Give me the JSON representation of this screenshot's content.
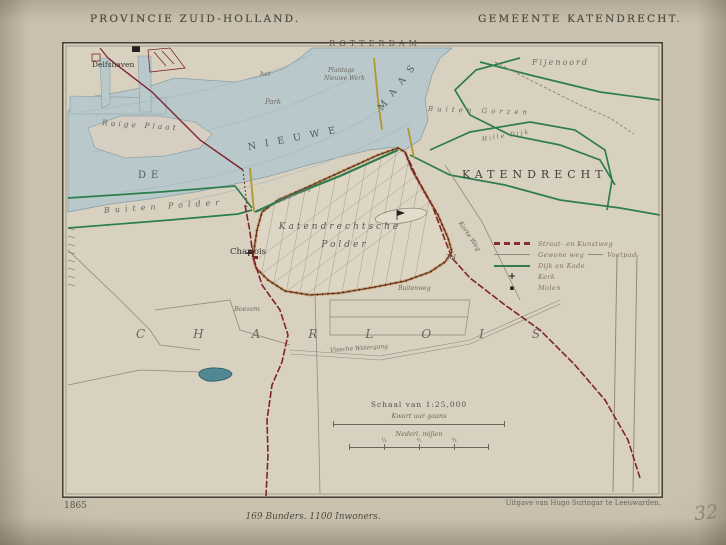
{
  "header": {
    "province": "PROVINCIE ZUID-HOLLAND.",
    "municipality": "GEMEENTE KATENDRECHT."
  },
  "map": {
    "labels": {
      "rotterdam": "ROTTERDAM",
      "delfshaven": "Delfshaven",
      "fijenoord": "Fijenoord",
      "het": "het",
      "park": "Park",
      "plantage": "Plantage",
      "nieuwe_werk": "Nieuwe Werk",
      "ruige_plaat": "Ruige Plaat",
      "de": "DE",
      "nieuwe": "NIEUWE",
      "maas": "MAAS",
      "katendrecht": "KATENDRECHT",
      "buiten_gorzen": "Buiten Gorzen",
      "hille_dijk": "Hille Dijk",
      "buiten_polder": "Buiten Polder",
      "buiten_weg": "Buiten Weg",
      "katendrechtsche": "Katendrechtsche",
      "polder": "Polder",
      "charlois_village": "Charlois",
      "boezem": "Boezem",
      "charlois": "CHARLOIS",
      "watergang": "Vissche Watergang",
      "buitenweg": "Buitenweg",
      "korte_weg": "Korte Weg",
      "tol": "Tol"
    },
    "symbols": {
      "church_cross": "+"
    }
  },
  "legend": {
    "items": [
      {
        "label": "Straat- en Kunstweg"
      },
      {
        "label": "Gewone weg",
        "label2": "Voetpad"
      },
      {
        "label": "Dijk en Kade"
      },
      {
        "symbol": "+",
        "label": "Kerk"
      },
      {
        "symbol": "▪",
        "label": "Molen"
      }
    ]
  },
  "scale": {
    "title": "Schaal van 1:25,000",
    "bar1_label": "Kwart uur gaans",
    "bar2_label": "Nederl. mijlen",
    "bar2_ticks": [
      "¼",
      "½",
      "¾"
    ]
  },
  "footer": {
    "year": "1865",
    "publisher": "Uitgave van Hugo Suringar te Leeuwarden.",
    "statistics": "169 Bunders. 1100 Inwoners.",
    "handwritten_number": "32"
  },
  "colors": {
    "paper": "#d9d1c0",
    "water": "#b9c8cb",
    "dike_green": "#2e7d4e",
    "road_red": "#7e2430",
    "polder_dike": "#6f2f1c",
    "pond": "#4f8892"
  }
}
